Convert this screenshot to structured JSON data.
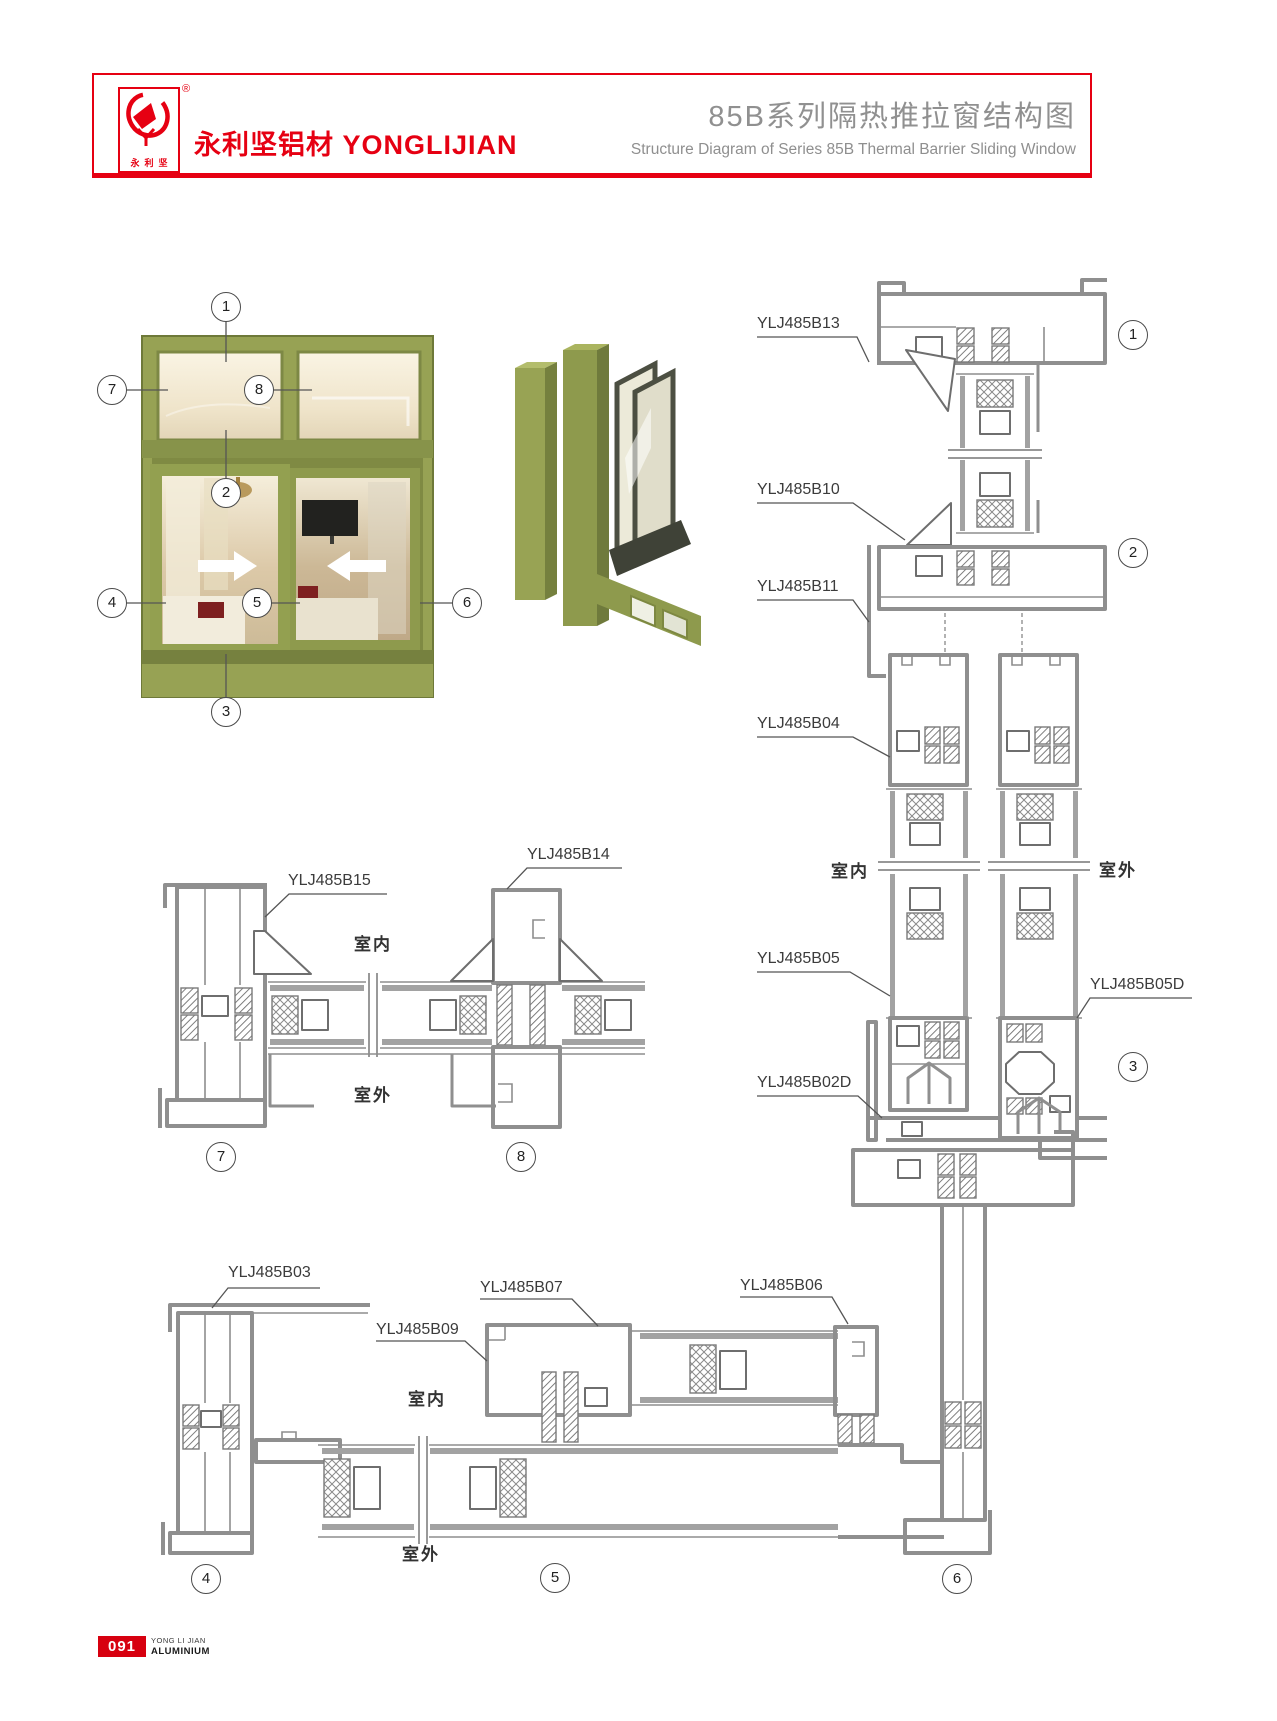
{
  "header": {
    "logo_chars": "永利坚",
    "registered": "®",
    "brand_cn": "永利坚铝材",
    "brand_en": "YONGLIJIAN",
    "title_cn": "85B系列隔热推拉窗结构图",
    "title_en": "Structure Diagram of Series 85B Thermal Barrier Sliding Window"
  },
  "photo": {
    "c1": "1",
    "c2": "2",
    "c3": "3",
    "c4": "4",
    "c5": "5",
    "c6": "6",
    "c7": "7",
    "c8": "8"
  },
  "vs": {
    "b13": "YLJ485B13",
    "b10": "YLJ485B10",
    "b11": "YLJ485B11",
    "b04": "YLJ485B04",
    "b05": "YLJ485B05",
    "b05d": "YLJ485B05D",
    "b02d": "YLJ485B02D",
    "indoor": "室内",
    "outdoor": "室外",
    "c1": "1",
    "c2": "2",
    "c3": "3"
  },
  "ms": {
    "b15": "YLJ485B15",
    "b14": "YLJ485B14",
    "indoor": "室内",
    "outdoor": "室外",
    "c7": "7",
    "c8": "8"
  },
  "bs": {
    "b03": "YLJ485B03",
    "b09": "YLJ485B09",
    "b07": "YLJ485B07",
    "b06": "YLJ485B06",
    "indoor": "室内",
    "outdoor": "室外",
    "c4": "4",
    "c5": "5",
    "c6": "6"
  },
  "footer": {
    "page": "091",
    "line1": "YONG LI JIAN",
    "line2": "ALUMINIUM"
  },
  "colors": {
    "accent": "#e60012",
    "title_gray": "#909090",
    "drawing_gray": "#8f8f8f",
    "olive_frame": "#97a254"
  }
}
